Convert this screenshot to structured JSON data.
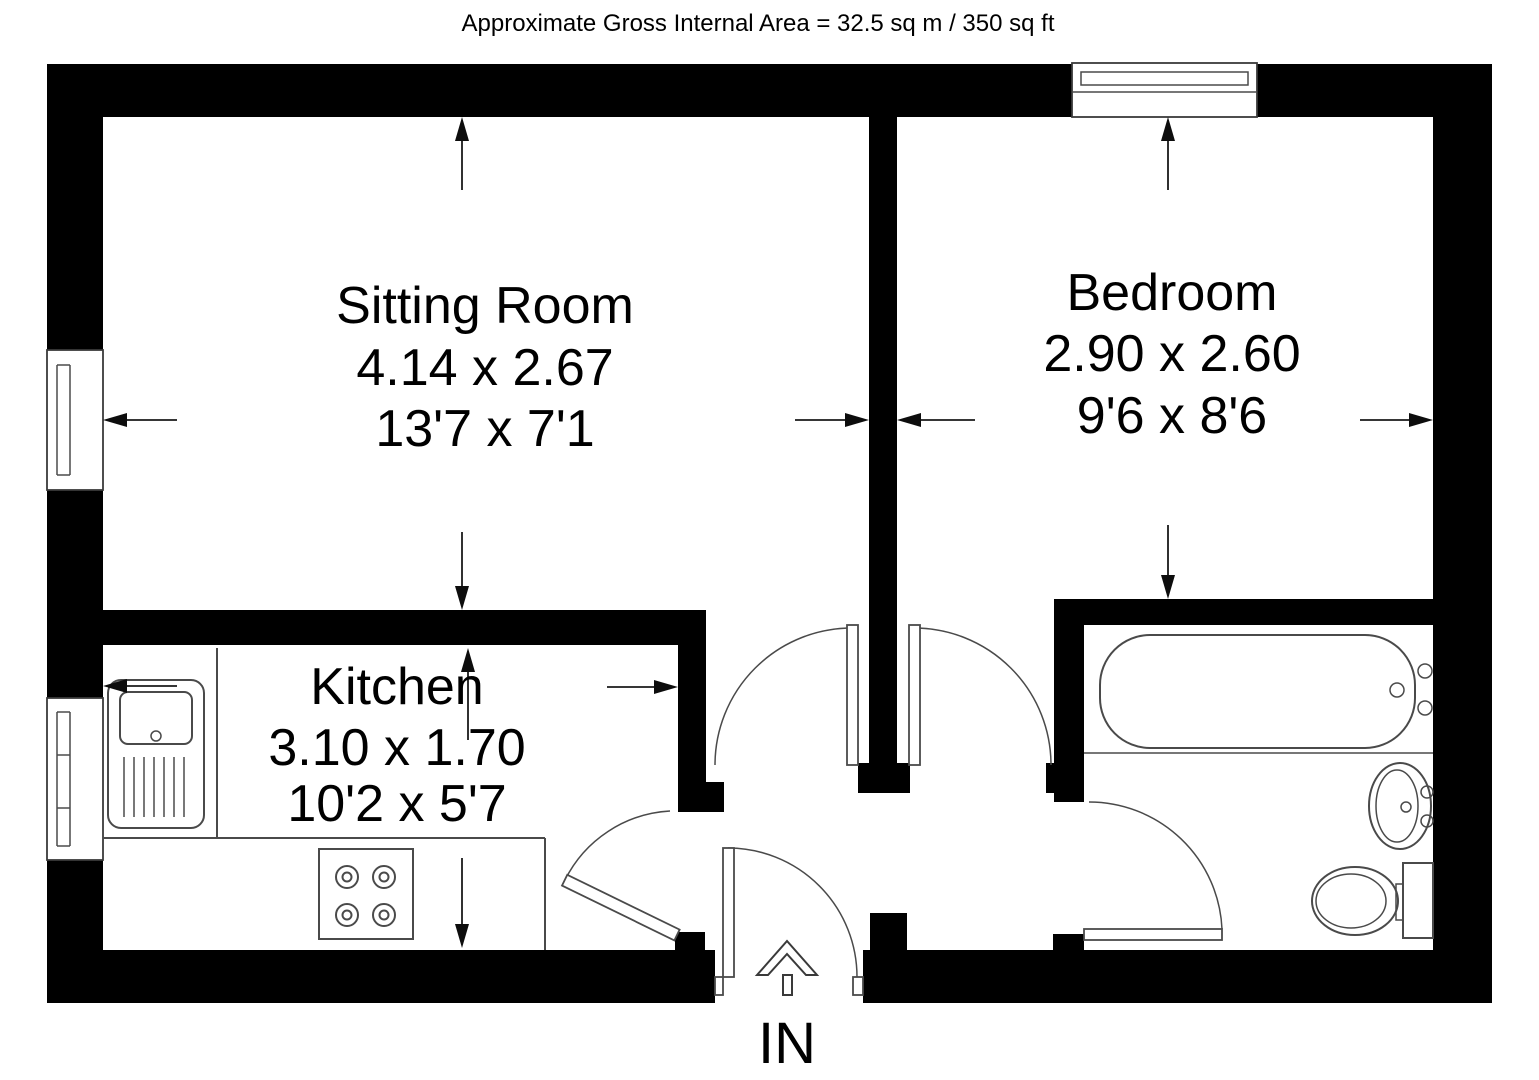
{
  "title": "Approximate Gross Internal Area = 32.5 sq m / 350 sq ft",
  "rooms": {
    "sitting_room": {
      "name": "Sitting Room",
      "size_metric": "4.14 x 2.67",
      "size_imperial": "13'7 x 7'1"
    },
    "bedroom": {
      "name": "Bedroom",
      "size_metric": "2.90 x 2.60",
      "size_imperial": "9'6 x 8'6"
    },
    "kitchen": {
      "name": "Kitchen",
      "size_metric": "3.10 x 1.70",
      "size_imperial": "10'2 x 5'7"
    }
  },
  "entrance": {
    "label": "IN"
  },
  "colors": {
    "wall": "#000000",
    "fixture_line": "#4a4a4a",
    "dimension_line": "#1a1a1a",
    "background": "#ffffff",
    "text": "#000000"
  }
}
